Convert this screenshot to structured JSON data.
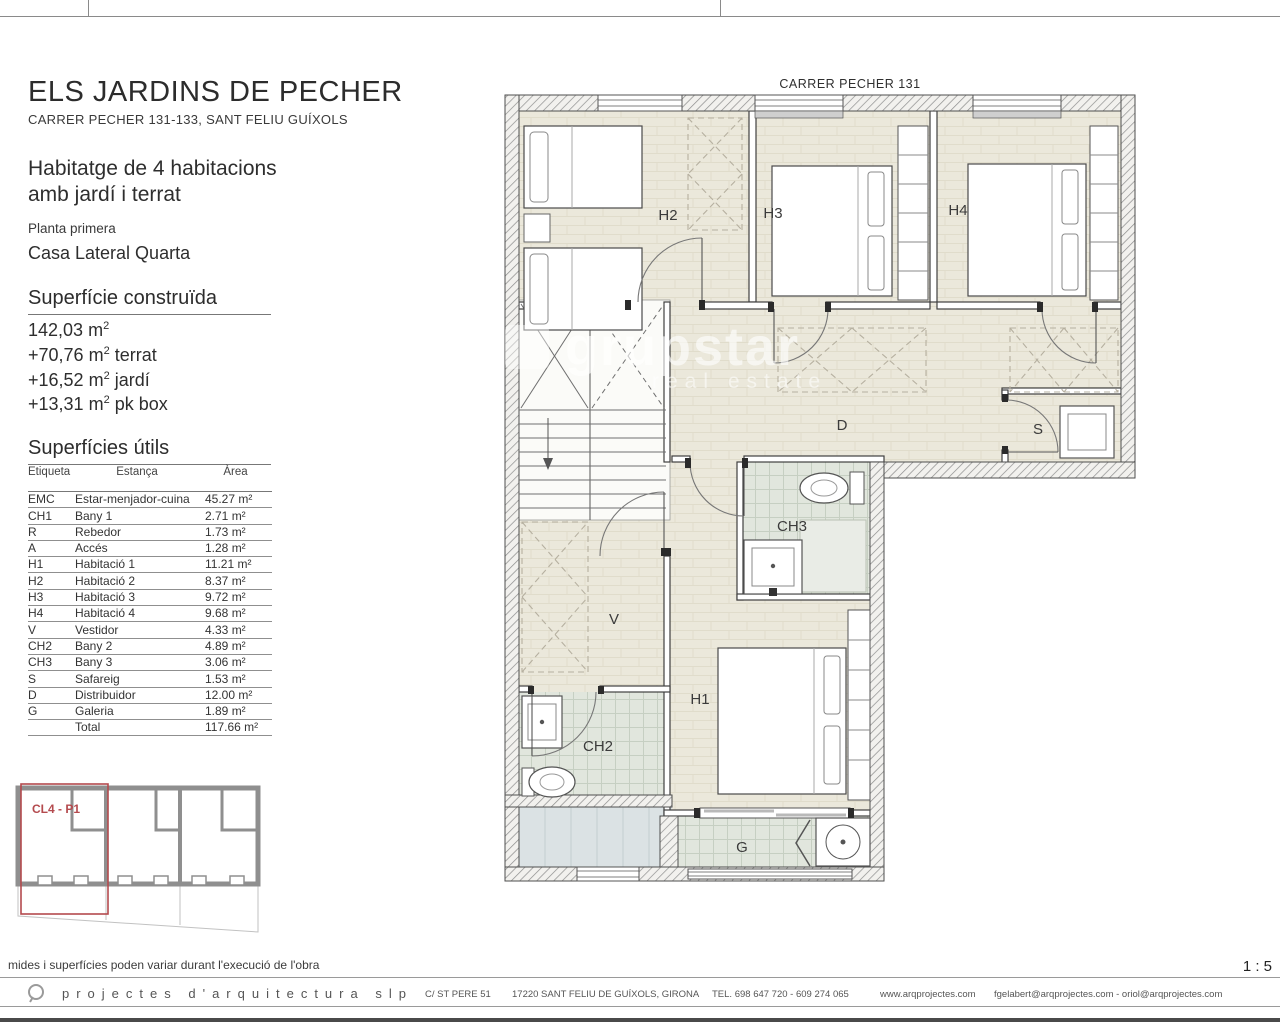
{
  "sheet": {
    "scale": "1 : 5",
    "note": "mides i superfícies poden variar durant l'execució de l'obra"
  },
  "header": {
    "title": "ELS JARDINS DE PECHER",
    "address": "CARRER PECHER 131-133, SANT FELIU GUÍXOLS"
  },
  "summary": {
    "line1": "Habitatge de 4 habitacions",
    "line2": "amb jardí i terrat",
    "floor": "Planta primera",
    "house": "Casa Lateral Quarta"
  },
  "units": {
    "base": "m",
    "exp": "2"
  },
  "built": {
    "heading": "Superfície construïda",
    "lines": [
      {
        "value": "142,03",
        "suffix": ""
      },
      {
        "value": "+70,76",
        "suffix": "terrat"
      },
      {
        "value": "+16,52",
        "suffix": "jardí"
      },
      {
        "value": "+13,31",
        "suffix": "pk box"
      }
    ]
  },
  "surfaces": {
    "heading": "Superfícies útils",
    "columns": {
      "label": "Etiqueta",
      "name": "Estança",
      "area": "Àrea"
    },
    "rows": [
      {
        "label": "EMC",
        "name": "Estar-menjador-cuina",
        "area": "45.27 m²"
      },
      {
        "label": "CH1",
        "name": "Bany 1",
        "area": "2.71 m²"
      },
      {
        "label": "R",
        "name": "Rebedor",
        "area": "1.73 m²"
      },
      {
        "label": "A",
        "name": "Accés",
        "area": "1.28 m²"
      },
      {
        "label": "H1",
        "name": "Habitació 1",
        "area": "11.21 m²"
      },
      {
        "label": "H2",
        "name": "Habitació 2",
        "area": "8.37 m²"
      },
      {
        "label": "H3",
        "name": "Habitació 3",
        "area": "9.72 m²"
      },
      {
        "label": "H4",
        "name": "Habitació 4",
        "area": "9.68 m²"
      },
      {
        "label": "V",
        "name": "Vestidor",
        "area": "4.33 m²"
      },
      {
        "label": "CH2",
        "name": "Bany 2",
        "area": "4.89 m²"
      },
      {
        "label": "CH3",
        "name": "Bany 3",
        "area": "3.06 m²"
      },
      {
        "label": "S",
        "name": "Safareig",
        "area": "1.53 m²"
      },
      {
        "label": "D",
        "name": "Distribuidor",
        "area": "12.00 m²"
      },
      {
        "label": "G",
        "name": "Galeria",
        "area": "1.89 m²"
      },
      {
        "label": "",
        "name": "Total",
        "area": "117.66 m²"
      }
    ]
  },
  "keyplan": {
    "label": "CL4 - P1",
    "accent_color": "#b44a4e"
  },
  "plan": {
    "street": "CARRER PECHER 131",
    "rooms": {
      "h2": "H2",
      "h3": "H3",
      "h4": "H4",
      "d": "D",
      "s": "S",
      "ch3": "CH3",
      "v": "V",
      "h1": "H1",
      "ch2": "CH2",
      "g": "G"
    }
  },
  "watermark": {
    "line1": "grupstar",
    "line2": "real estate"
  },
  "footer": {
    "brand": "projectes d'arquitectura slp",
    "address": "C/ ST PERE 51",
    "city": "17220 SANT FELIU DE GUÍXOLS, GIRONA",
    "phone": "TEL. 698 647 720 - 609 274 065",
    "web": "www.arqprojectes.com",
    "emails": "fgelabert@arqprojectes.com - oriol@arqprojectes.com"
  }
}
